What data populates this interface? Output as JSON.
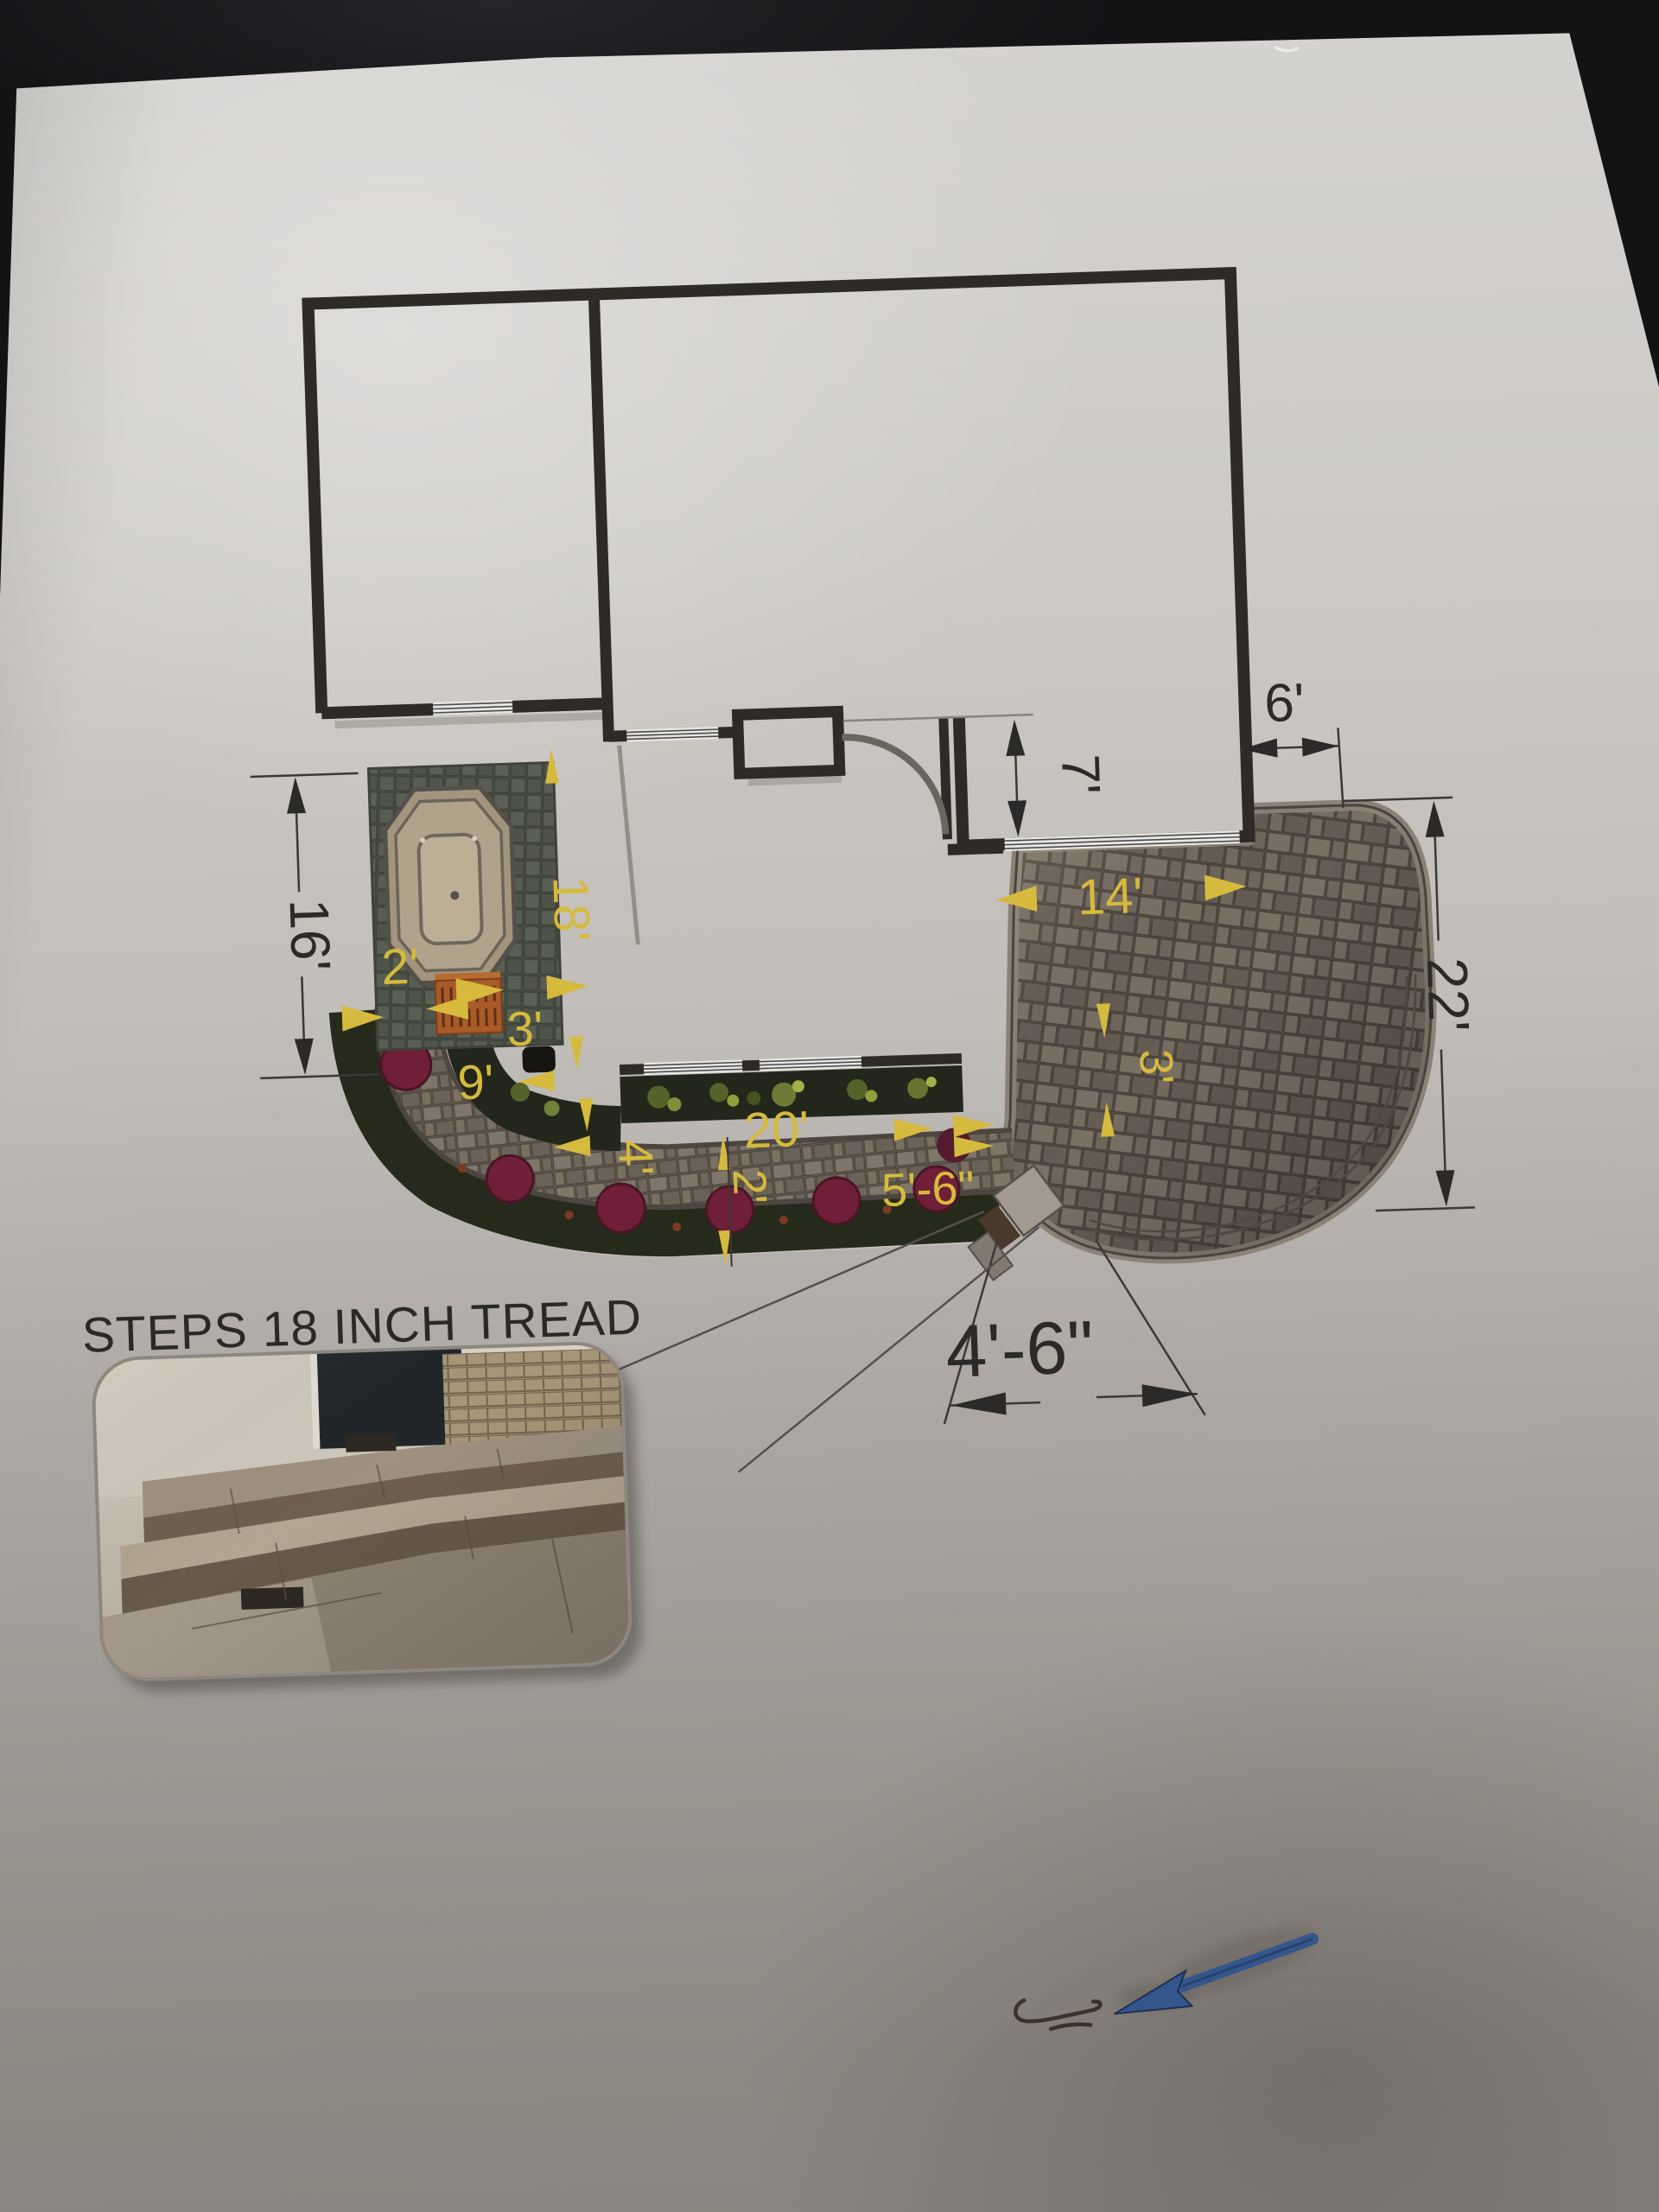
{
  "document": {
    "note": "STEPS 18 INCH TREAD"
  },
  "dimensions": {
    "black": {
      "d6": "6'",
      "d7": "7'",
      "d16": "16'",
      "d22": "22'",
      "d46": "4'-6\""
    },
    "yellow": {
      "spa_gap": "2'",
      "run_18": "18'",
      "spa_steps": "3'",
      "walk_9": "9'",
      "bed_4": "4'",
      "walk_20": "20'",
      "bed_2": "2'",
      "steps_56": "5'-6\"",
      "patio_14": "14'",
      "patio_3": "3'"
    }
  },
  "colors": {
    "paper": "#c9c6c2",
    "wall": "#2e2b27",
    "dim_line": "#3a3936",
    "yellow": "#d6ba3e",
    "patio_base": "#6b635a",
    "patio_joint": "#463f38",
    "bed_dark": "#23261b",
    "shrub_maroon": "#6f1f38",
    "spa_pad": "#565b50",
    "tub_tan": "#b0a28b",
    "steps_orange": "#a85a28",
    "arrow_blue": "#35568c"
  }
}
